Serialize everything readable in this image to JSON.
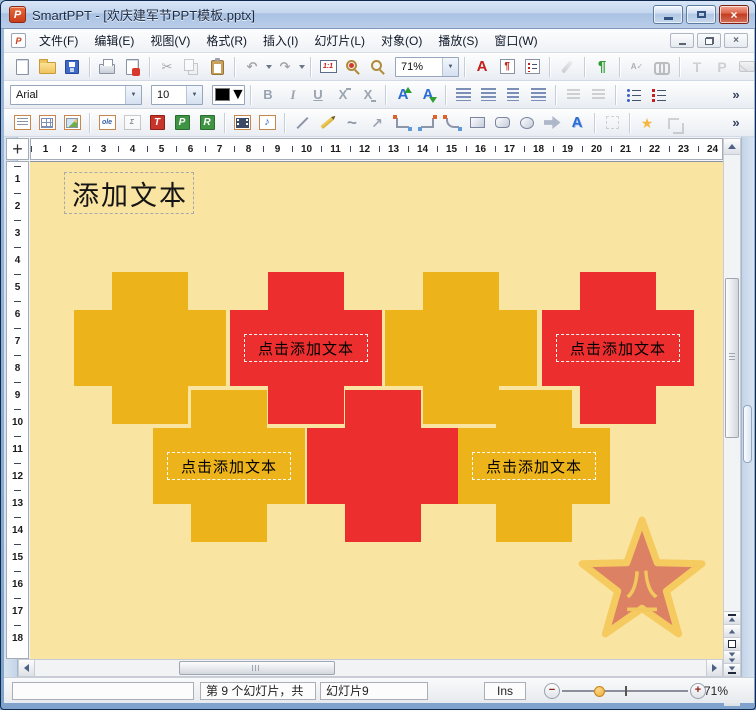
{
  "window": {
    "title": "SmartPPT - [欢庆建军节PPT模板.pptx]",
    "app_icon_letter": "P"
  },
  "menu": {
    "items": [
      "文件(F)",
      "编辑(E)",
      "视图(V)",
      "格式(R)",
      "插入(I)",
      "幻灯片(L)",
      "对象(O)",
      "播放(S)",
      "窗口(W)"
    ]
  },
  "toolbars": {
    "zoom_select_value": "71%",
    "font_name_value": "Arial",
    "font_size_value": "10",
    "glyphs": {
      "cut": "✂",
      "undo": "↶",
      "redo": "↷",
      "scale": "1:1",
      "font_color_a": "A",
      "pilcrow": "¶",
      "paragraph_mark": "¶",
      "spellcheck": "A✓",
      "letter_t": "T",
      "letter_p": "P",
      "bold": "B",
      "italic": "I",
      "underline": "U",
      "strike_a": "X",
      "strike_b": "X",
      "grow_font": "A",
      "shrink_font": "A",
      "ole": "ole",
      "sigma": "Σ",
      "frame_t": "T",
      "frame_p": "P",
      "frame_r": "R",
      "note": "♪",
      "curve": "~",
      "arrow_ne": "↗",
      "wordart": "A",
      "overflow": "»",
      "close": "×",
      "dropdown": "▼"
    }
  },
  "rulers": {
    "horizontal": [
      1,
      2,
      3,
      4,
      5,
      6,
      7,
      8,
      9,
      10,
      11,
      12,
      13,
      14,
      15,
      16,
      17,
      18,
      19,
      20,
      21,
      22,
      23,
      24,
      25
    ],
    "vertical": [
      1,
      2,
      3,
      4,
      5,
      6,
      7,
      8,
      9,
      10,
      11,
      12,
      13,
      14,
      15,
      16,
      17,
      18
    ]
  },
  "slide": {
    "background": "#FAE4A1",
    "title_placeholder": "添加文本",
    "placeholder_text": "点击添加文本",
    "cross_yellow": "#ECB31A",
    "cross_red": "#ED2E2E",
    "crosses": [
      {
        "color": "yellow",
        "x": 44,
        "y": 110,
        "has_text": false
      },
      {
        "color": "red",
        "x": 200,
        "y": 110,
        "has_text": true
      },
      {
        "color": "yellow",
        "x": 355,
        "y": 110,
        "has_text": false
      },
      {
        "color": "red",
        "x": 512,
        "y": 110,
        "has_text": true
      },
      {
        "color": "yellow",
        "x": 123,
        "y": 228,
        "has_text": true
      },
      {
        "color": "red",
        "x": 277,
        "y": 228,
        "has_text": false
      },
      {
        "color": "yellow",
        "x": 428,
        "y": 228,
        "has_text": true
      }
    ],
    "star_badge": {
      "line1": "八",
      "line2": "一",
      "fill": "#DD8164",
      "stroke": "#F5CB5F",
      "text_color": "#F2C75E"
    }
  },
  "statusbar": {
    "slide_position": "第 9 个幻灯片，共",
    "slide_name": "幻灯片9",
    "insert_mode": "Ins",
    "zoom_out_glyph": "−",
    "zoom_in_glyph": "+",
    "zoom_percent": "71%"
  }
}
